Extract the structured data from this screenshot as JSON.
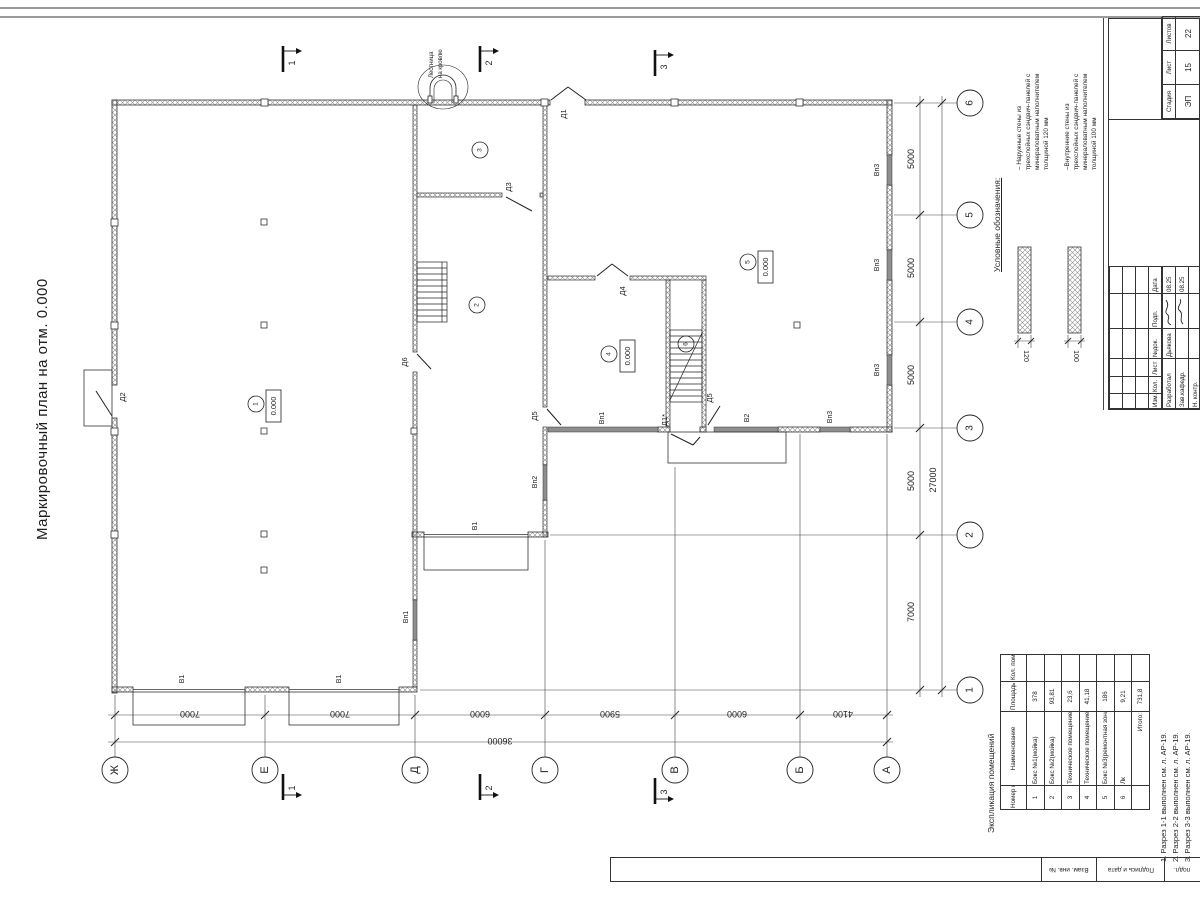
{
  "main_title": "Маркировочный план на отм. 0.000",
  "legend": {
    "title": "Условные обозначения:",
    "items": [
      {
        "text": "– Наружные стены из трехслойных сэндвич-панелей с минераловатным наполнителем толщиной 120 мм",
        "dim": "120"
      },
      {
        "text": "–Внутренние стены из трехслойных сэндвич-панелей с минераловатным наполнителем толщиной 100 мм",
        "dim": "100"
      }
    ]
  },
  "plan": {
    "roof_ladder_line1": "Лестница",
    "roof_ladder_line2": "на кровлю",
    "elevation_mark": "0.000",
    "axis_letters": [
      "Ж",
      "Е",
      "Д",
      "Г",
      "В",
      "Б",
      "А"
    ],
    "axis_numbers": [
      "6",
      "5",
      "4",
      "3",
      "2",
      "1"
    ],
    "dims_bottom": [
      "7000",
      "7000",
      "6000",
      "5900",
      "6000",
      "4100"
    ],
    "dim_bottom_total": "36000",
    "dims_right": [
      "5000",
      "5000",
      "5000",
      "5000",
      "7000"
    ],
    "dim_right_total": "27000",
    "sections": [
      "1",
      "2",
      "3"
    ],
    "door_labels": {
      "d1": "Д1",
      "d2": "Д2",
      "d3": "Д3",
      "d4": "Д4",
      "d5": "Д5",
      "d6": "Д6",
      "d1s": "Д1*"
    },
    "opening_labels": {
      "v1": "В1",
      "v2": "В2",
      "vp1": "Вп1",
      "vp2": "Вп2",
      "vp3": "Вп3"
    },
    "room_numbers": [
      "1",
      "2",
      "3",
      "4",
      "5",
      "6"
    ]
  },
  "explication": {
    "title": "Экспликация помещений",
    "headers": {
      "num": "Номер помещ.",
      "name": "Наименование",
      "area": "Площадь, м2",
      "count": "Кол. пом."
    },
    "rows": [
      {
        "num": "1",
        "name": "Бокс №1(мойка)",
        "area": "378",
        "count": ""
      },
      {
        "num": "2",
        "name": "Бокс №2(мойка)",
        "area": "93,81",
        "count": ""
      },
      {
        "num": "3",
        "name": "Техническое помещение",
        "area": "23,6",
        "count": ""
      },
      {
        "num": "4",
        "name": "Техническое помещение",
        "area": "41,18",
        "count": ""
      },
      {
        "num": "5",
        "name": "Бокс №3(ремонтная зона)",
        "area": "186",
        "count": ""
      },
      {
        "num": "6",
        "name": "Лк",
        "area": "9,21",
        "count": ""
      },
      {
        "num": "",
        "name": "Итого:",
        "area": "731,8",
        "count": ""
      }
    ]
  },
  "notes": [
    "1. Разрез 1-1 выполнен см. л. АР-19.",
    "2. Разрез 2-2 выполнен см. л. АР-19.",
    "3. Разрез 3-3 выполнен см. л. АР-19."
  ],
  "stamp": {
    "header_cols": [
      "Изм.",
      "Кол.",
      "Лист",
      "№док.",
      "Подп.",
      "Дата"
    ],
    "staff_rows": [
      {
        "role": "Разработал",
        "name": "Дьякова",
        "date": "08.25"
      },
      {
        "role": "Зав.кафедр.",
        "name": "",
        "date": "08.25"
      },
      {
        "role": "Н. контр.",
        "name": "",
        "date": ""
      }
    ],
    "stage_headers": [
      "Стадия",
      "Лист",
      "Листов"
    ],
    "stage_values": [
      "ЭП",
      "15",
      "22"
    ]
  },
  "frame": {
    "cells": [
      "Взам. инв. №",
      "Подпись и дата",
      "подл."
    ]
  }
}
